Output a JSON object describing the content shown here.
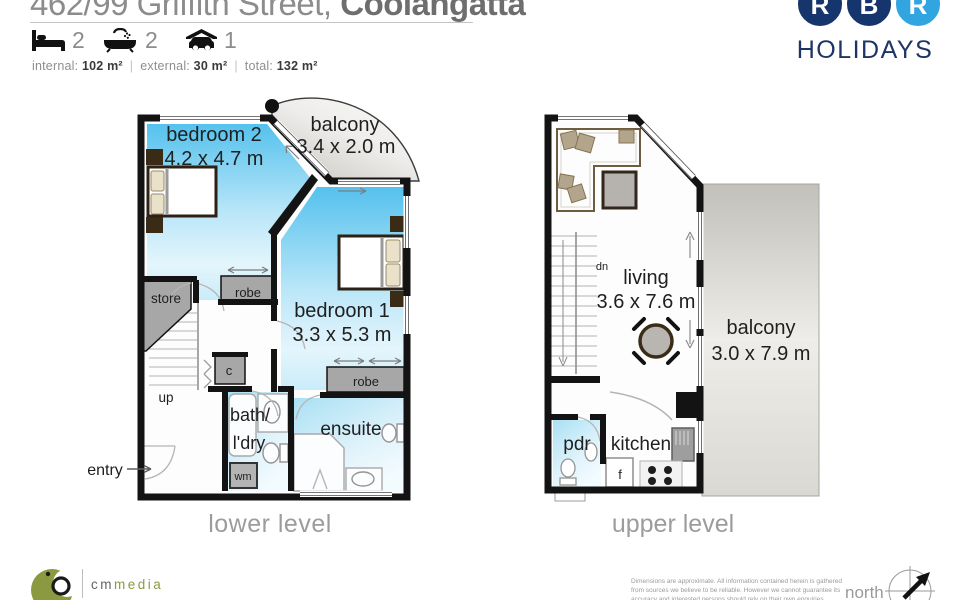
{
  "header": {
    "address_prefix": "462/99 Griffith Street, ",
    "address_suffix": "Coolangatta",
    "beds": "2",
    "baths": "2",
    "cars": "1",
    "areas": {
      "internal_label": "internal:",
      "internal_value": "102 m²",
      "external_label": "external:",
      "external_value": "30 m²",
      "total_label": "total:",
      "total_value": "132 m²"
    }
  },
  "brand": {
    "circle_letters": [
      "R",
      "B",
      "R"
    ],
    "word": "HOLIDAYS",
    "navy": "#16356c",
    "light_blue": "#31a5e0"
  },
  "lower_plan": {
    "title": "lower level",
    "bedroom2_name": "bedroom 2",
    "bedroom2_dims": "4.2 x 4.7 m",
    "balcony_name": "balcony",
    "balcony_dims": "3.4 x 2.0 m",
    "bedroom1_name": "bedroom 1",
    "bedroom1_dims": "3.3 x 5.3 m",
    "store": "store",
    "robe_a": "robe",
    "robe_b": "robe",
    "cupboard": "c",
    "up": "up",
    "bath_line1": "bath/",
    "bath_line2": "l'dry",
    "ensuite": "ensuite",
    "wm": "wm",
    "entry": "entry"
  },
  "upper_plan": {
    "title": "upper level",
    "living_name": "living",
    "living_dims": "3.6 x 7.6 m",
    "balcony_name": "balcony",
    "balcony_dims": "3.0 x 7.9 m",
    "dn": "dn",
    "pdr": "pdr",
    "kitchen": "kitchen",
    "fridge": "f"
  },
  "footer": {
    "media_brand_prefix": "cm",
    "media_brand_suffix": "media",
    "disclaimer_line1": "Dimensions are approximate.  All information contained herein is gathered",
    "disclaimer_line2": "from sources we believe to be reliable.  However we cannot guarantee its",
    "disclaimer_line3": "accuracy and interested persons should rely on their own enquiries.",
    "north": "north"
  },
  "colors": {
    "wall_black": "#131313",
    "room_blue": "#55c1ed",
    "wet_room_blue": "#a9e0f4",
    "robe_gray": "#a7a7a7",
    "balcony_gray": "#c7c5c0",
    "label_gray": "#9c9c9c",
    "navy": "#16356c",
    "light_blue": "#31a5e0",
    "olive": "#8b9a41"
  }
}
